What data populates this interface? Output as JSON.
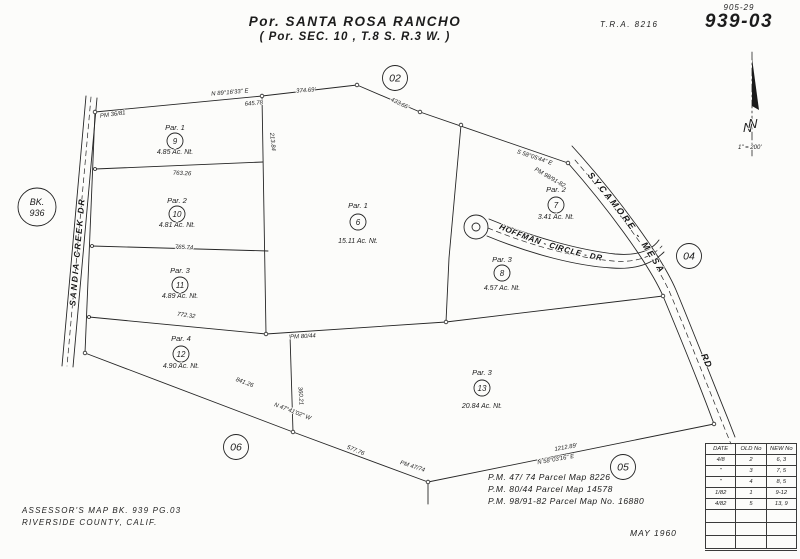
{
  "header": {
    "page_ref": "905-29",
    "map_number": "939-03",
    "tra": "T.R.A.  8216",
    "title_line1": "Por. SANTA ROSA RANCHO",
    "title_line2": "( Por. SEC. 10 , T.8 S. R.3 W. )"
  },
  "north_arrow": {
    "label": "N",
    "scale": "1\" = 200'"
  },
  "ref_circles": [
    {
      "label": "02",
      "x": 395,
      "y": 78
    },
    {
      "label": "04",
      "x": 689,
      "y": 256
    },
    {
      "label": "05",
      "x": 623,
      "y": 467
    },
    {
      "label": "06",
      "x": 236,
      "y": 447
    }
  ],
  "book_circle": {
    "line1": "BK.",
    "line2": "936",
    "x": 37,
    "y": 207
  },
  "parcels": [
    {
      "par": "Par. 1",
      "num": "9",
      "ac": "4.85 Ac. Nt.",
      "x": 175,
      "ny": 130,
      "cy": 141,
      "ay": 154
    },
    {
      "par": "Par. 2",
      "num": "10",
      "ac": "4.81 Ac. Nt.",
      "x": 177,
      "ny": 203,
      "cy": 214,
      "ay": 227
    },
    {
      "par": "Par. 3",
      "num": "11",
      "ac": "4.89 Ac. Nt.",
      "x": 180,
      "ny": 273,
      "cy": 285,
      "ay": 298
    },
    {
      "par": "Par. 4",
      "num": "12",
      "ac": "4.90 Ac. Nt.",
      "x": 181,
      "ny": 341,
      "cy": 354,
      "ay": 368
    },
    {
      "par": "Par. 1",
      "num": "6",
      "ac": "15.11 Ac. Nt.",
      "x": 358,
      "ny": 208,
      "cy": 222,
      "ay": 243
    },
    {
      "par": "Par. 2",
      "num": "7",
      "ac": "3.41 Ac. Nt.",
      "x": 556,
      "ny": 192,
      "cy": 205,
      "ay": 219
    },
    {
      "par": "Par. 3",
      "num": "8",
      "ac": "4.57 Ac. Nt.",
      "x": 502,
      "ny": 262,
      "cy": 273,
      "ay": 290
    },
    {
      "par": "Par. 3",
      "num": "13",
      "ac": "20.84 Ac. Nt.",
      "x": 482,
      "ny": 375,
      "cy": 388,
      "ay": 408
    }
  ],
  "roads": [
    {
      "name": "SANDIA  CREEK  DR",
      "mode": "rotate",
      "x": 80,
      "y": 252,
      "rot": -85,
      "size": 8.5,
      "ls": 2
    },
    {
      "name": "SYCAMORE - MESA",
      "mode": "path",
      "guide": "guide-sycamore",
      "offset": 2,
      "size": 9,
      "ls": 2.5
    },
    {
      "name": "RD",
      "mode": "rotate",
      "x": 704,
      "y": 362,
      "rot": 66,
      "size": 9,
      "ls": 1
    },
    {
      "name": "HOFFMAN - CIRCLE - DR",
      "mode": "path",
      "guide": "guide-hoffman",
      "offset": 4,
      "size": 8,
      "ls": 0.6
    }
  ],
  "dimensions": [
    {
      "t": "N 89°16'33\" E",
      "x": 230,
      "y": 94,
      "r": -5
    },
    {
      "t": "645.78",
      "x": 254,
      "y": 105,
      "r": -5
    },
    {
      "t": "374.69'",
      "x": 306,
      "y": 92,
      "r": -4
    },
    {
      "t": "433.66'",
      "x": 399,
      "y": 105,
      "r": 26
    },
    {
      "t": "763.26",
      "x": 182,
      "y": 175,
      "r": 2
    },
    {
      "t": "765.74",
      "x": 184,
      "y": 249,
      "r": 2
    },
    {
      "t": "772.32",
      "x": 186,
      "y": 317,
      "r": 8
    },
    {
      "t": "841.26",
      "x": 244,
      "y": 384,
      "r": 21
    },
    {
      "t": "N 47°41'02\" W",
      "x": 292,
      "y": 413,
      "r": 21
    },
    {
      "t": "577.76",
      "x": 355,
      "y": 452,
      "r": 22
    },
    {
      "t": "PM 47/74",
      "x": 412,
      "y": 468,
      "r": 18
    },
    {
      "t": "1212.89'",
      "x": 566,
      "y": 449,
      "r": -10
    },
    {
      "t": "N 58°03'16\" E",
      "x": 556,
      "y": 461,
      "r": -10
    },
    {
      "t": "PM 36/81",
      "x": 113,
      "y": 116,
      "r": -8
    },
    {
      "t": "PM 80/44",
      "x": 303,
      "y": 338,
      "r": -3
    },
    {
      "t": "213.84",
      "x": 271,
      "y": 142,
      "r": 84
    },
    {
      "t": "360.21",
      "x": 299,
      "y": 396,
      "r": 86
    },
    {
      "t": "S 58°05'44\" E",
      "x": 534,
      "y": 159,
      "r": 19
    },
    {
      "t": "PM 98/91-82",
      "x": 549,
      "y": 179,
      "r": 30
    }
  ],
  "notes": {
    "pm_lines": [
      "P.M. 47/ 74   Parcel Map  8226",
      "P.M. 80/44   Parcel Map  14578",
      "P.M. 98/91-82  Parcel Map No. 16880"
    ],
    "assessor_line1": "ASSESSOR'S   MAP   BK. 939   PG.03",
    "assessor_line2": "RIVERSIDE    COUNTY,    CALIF.",
    "date": "MAY 1960"
  },
  "revision_table": {
    "headers": [
      "DATE",
      "OLD No",
      "NEW No"
    ],
    "rows": [
      [
        "4/8",
        "2",
        "6, 3"
      ],
      [
        "\"",
        "3",
        "7, 5"
      ],
      [
        "\"",
        "4",
        "8, 5"
      ],
      [
        "1/82",
        "1",
        "9-12"
      ],
      [
        "4/82",
        "5",
        "13, 9"
      ]
    ],
    "empty_rows": 3
  }
}
